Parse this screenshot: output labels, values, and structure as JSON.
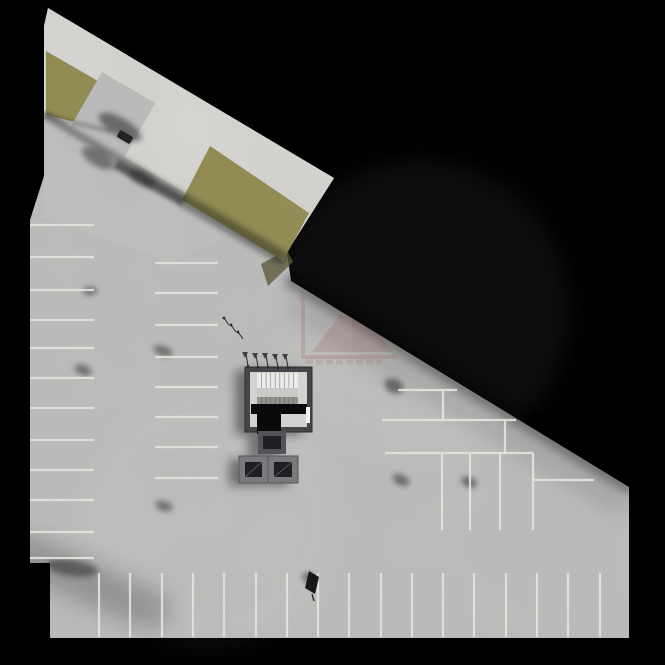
{
  "scene": {
    "w": 665,
    "h": 665,
    "colors": {
      "bg": "#000000",
      "floor": "#bdbdbc",
      "band": "#d9d8d4",
      "grass": "#8d8746",
      "grass_dark": "#595535",
      "line": "#edebe6",
      "wall": "#46464a",
      "wall_dark": "#2c2c2f",
      "core_floor": "#d3d2d0",
      "stair_light": "#ebebe9",
      "stair_mid": "#c9c9c7",
      "stair_dark": "#93938d",
      "pit": "#0a0a0c",
      "frame_light": "#7a7a7d",
      "frame_mid": "#525257",
      "inner_dark": "#1e1e23",
      "door": "#f2f2f0",
      "watermark": "#9c5c5c",
      "watermark_dark": "#7c4348",
      "mark": "#2b2b2b"
    },
    "site_outline": [
      [
        48,
        8
      ],
      [
        334,
        178
      ],
      [
        287,
        252
      ],
      [
        291,
        281
      ],
      [
        629,
        487
      ],
      [
        629,
        638
      ],
      [
        50,
        638
      ],
      [
        50,
        563
      ],
      [
        30,
        563
      ],
      [
        30,
        220
      ],
      [
        44,
        176
      ],
      [
        44,
        26
      ]
    ],
    "band_outline": [
      [
        48,
        8
      ],
      [
        334,
        178
      ],
      [
        287,
        252
      ],
      [
        44,
        110
      ],
      [
        44,
        26
      ]
    ],
    "plaza_overlay": [
      [
        44,
        116
      ],
      [
        240,
        232
      ],
      [
        170,
        262
      ],
      [
        44,
        218
      ]
    ],
    "grass_patches": [
      [
        [
          46,
          51
        ],
        [
          122,
          95
        ],
        [
          110,
          130
        ],
        [
          46,
          115
        ]
      ],
      [
        [
          210,
          146
        ],
        [
          309,
          213
        ],
        [
          283,
          261
        ],
        [
          182,
          200
        ]
      ]
    ],
    "grass_end_face": [
      [
        287,
        250
      ],
      [
        293,
        262
      ],
      [
        268,
        286
      ],
      [
        261,
        264
      ]
    ],
    "ramp": {
      "poly": [
        [
          102,
          72
        ],
        [
          155,
          103
        ],
        [
          113,
          178
        ],
        [
          60,
          145
        ]
      ],
      "slot": [
        [
          118,
          160
        ],
        [
          186,
          198
        ],
        [
          181,
          206
        ],
        [
          113,
          168
        ]
      ],
      "gate": {
        "x": 125,
        "y": 137,
        "w": 15,
        "h": 8,
        "angle": 31
      },
      "gate_arm": [
        131,
        141,
        141,
        148
      ]
    },
    "shadow_lines": [
      {
        "x1": 291,
        "y1": 281,
        "x2": 629,
        "y2": 487,
        "w": 12,
        "o": 0.45,
        "f": "b5"
      },
      {
        "x1": 300,
        "y1": 305,
        "x2": 620,
        "y2": 500,
        "w": 26,
        "o": 0.15,
        "f": "b12"
      },
      {
        "x1": 46,
        "y1": 116,
        "x2": 285,
        "y2": 255,
        "w": 7,
        "o": 0.4,
        "f": "b3"
      },
      {
        "x1": 184,
        "y1": 204,
        "x2": 281,
        "y2": 260,
        "w": 8,
        "o": 0.4,
        "f": "b3"
      },
      {
        "x1": 46,
        "y1": 116,
        "x2": 110,
        "y2": 131,
        "w": 4,
        "o": 0.3,
        "f": "b2"
      },
      {
        "x1": 31,
        "y1": 222,
        "x2": 31,
        "y2": 562,
        "w": 4,
        "o": 0.3,
        "f": "b2"
      },
      {
        "x1": 51,
        "y1": 564,
        "x2": 51,
        "y2": 636,
        "w": 4,
        "o": 0.3,
        "f": "b2"
      },
      {
        "x1": 31,
        "y1": 222,
        "x2": 94,
        "y2": 222,
        "w": 8,
        "o": 0.4,
        "f": "b3"
      },
      {
        "x1": 60,
        "y1": 634,
        "x2": 625,
        "y2": 634,
        "w": 8,
        "o": 0.25,
        "f": "b5"
      },
      {
        "x1": 25,
        "y1": 555,
        "x2": 150,
        "y2": 610,
        "w": 40,
        "o": 0.25,
        "f": "b12"
      }
    ],
    "shadow_blobs": [
      {
        "x": 90,
        "y": 291,
        "rx": 7,
        "ry": 4,
        "rot": 0,
        "o": 0.5
      },
      {
        "x": 83,
        "y": 370,
        "rx": 9,
        "ry": 5,
        "rot": 20,
        "o": 0.45
      },
      {
        "x": 163,
        "y": 351,
        "rx": 10,
        "ry": 5,
        "rot": 20,
        "o": 0.45
      },
      {
        "x": 164,
        "y": 506,
        "rx": 9,
        "ry": 5,
        "rot": 15,
        "o": 0.45
      },
      {
        "x": 394,
        "y": 386,
        "rx": 10,
        "ry": 7,
        "rot": 25,
        "o": 0.5
      },
      {
        "x": 401,
        "y": 480,
        "rx": 9,
        "ry": 5,
        "rot": 25,
        "o": 0.5
      },
      {
        "x": 469,
        "y": 482,
        "rx": 8,
        "ry": 5,
        "rot": 25,
        "o": 0.5
      },
      {
        "x": 309,
        "y": 578,
        "rx": 7,
        "ry": 5,
        "rot": 30,
        "o": 0.5
      },
      {
        "x": 120,
        "y": 127,
        "rx": 24,
        "ry": 9,
        "rot": 30,
        "o": 0.5
      },
      {
        "x": 98,
        "y": 158,
        "rx": 18,
        "ry": 8,
        "rot": 30,
        "o": 0.45
      },
      {
        "x": 142,
        "y": 178,
        "rx": 14,
        "ry": 7,
        "rot": 30,
        "o": 0.4
      },
      {
        "x": 72,
        "y": 568,
        "rx": 26,
        "ry": 8,
        "rot": 8,
        "o": 0.45
      }
    ],
    "light_blobs": [
      {
        "x": 420,
        "y": 310,
        "r": 150,
        "o": 0.05
      },
      {
        "x": 210,
        "y": 520,
        "r": 130,
        "o": 0.04
      }
    ],
    "parking_lines": {
      "left_col": {
        "x1": 30,
        "x2": 94,
        "ys": [
          225,
          257,
          290,
          320,
          348,
          378,
          408,
          440,
          470,
          500,
          532,
          558
        ]
      },
      "mid_col": {
        "x1": 155,
        "x2": 218,
        "ys": [
          263,
          293,
          325,
          357,
          387,
          417,
          447,
          478
        ]
      },
      "bottom_row": {
        "y1": 573,
        "y2": 637,
        "xs": [
          99,
          130,
          162,
          193,
          224,
          256,
          287,
          318,
          349,
          381,
          412,
          443,
          474,
          506,
          537,
          568,
          600
        ]
      },
      "right_segments": [
        {
          "x1": 398,
          "y1": 390,
          "x2": 457,
          "y2": 390
        },
        {
          "x1": 443,
          "y1": 390,
          "x2": 443,
          "y2": 420
        },
        {
          "x1": 382,
          "y1": 420,
          "x2": 516,
          "y2": 420
        },
        {
          "x1": 505,
          "y1": 420,
          "x2": 505,
          "y2": 453
        },
        {
          "x1": 385,
          "y1": 453,
          "x2": 533,
          "y2": 453
        },
        {
          "x1": 442,
          "y1": 453,
          "x2": 442,
          "y2": 530
        },
        {
          "x1": 470,
          "y1": 453,
          "x2": 470,
          "y2": 530
        },
        {
          "x1": 500,
          "y1": 453,
          "x2": 500,
          "y2": 530
        },
        {
          "x1": 533,
          "y1": 453,
          "x2": 533,
          "y2": 530
        },
        {
          "x1": 533,
          "y1": 480,
          "x2": 594,
          "y2": 480
        }
      ]
    },
    "core": {
      "room": {
        "x": 245,
        "y": 367,
        "w": 67,
        "h": 65
      },
      "inner": {
        "x": 250,
        "y": 372,
        "w": 57,
        "h": 55
      },
      "treads": {
        "x": 257,
        "y": 373,
        "w": 41,
        "h": 15,
        "n": 9
      },
      "landing": {
        "x": 257,
        "y": 388,
        "w": 41,
        "h": 9
      },
      "flight2": {
        "x": 257,
        "y": 397,
        "w": 41,
        "h": 7,
        "n": 9
      },
      "pit_bar": {
        "x": 251,
        "y": 404,
        "w": 56,
        "h": 10
      },
      "pit_block": {
        "x": 257,
        "y": 413,
        "w": 24,
        "h": 21
      },
      "door": {
        "x": 306,
        "y": 407,
        "w": 4,
        "h": 16
      },
      "vent": {
        "x": 258,
        "y": 431,
        "w": 28,
        "h": 23,
        "inset": 5
      },
      "boxes": [
        {
          "x": 239,
          "y": 456,
          "w": 29,
          "h": 27,
          "inset": 6
        },
        {
          "x": 268,
          "y": 456,
          "w": 30,
          "h": 27,
          "inset": 6
        }
      ]
    },
    "marks": {
      "sprinklers": [
        [
          248,
          366
        ],
        [
          258,
          367
        ],
        [
          268,
          367
        ],
        [
          278,
          368
        ],
        [
          288,
          368
        ]
      ],
      "bikes": [
        [
          224,
          318
        ],
        [
          231,
          325
        ],
        [
          238,
          332
        ]
      ],
      "sign": {
        "poly": [
          [
            309,
            571
          ],
          [
            319,
            577
          ],
          [
            315,
            594
          ],
          [
            305,
            588
          ]
        ],
        "stem": [
          312,
          594,
          314,
          601
        ]
      }
    },
    "watermark": {
      "bracket": [
        [
          303,
          291
        ],
        [
          303,
          357
        ],
        [
          397,
          357
        ]
      ],
      "pyramid": [
        [
          312,
          352
        ],
        [
          352,
          299
        ],
        [
          393,
          352
        ]
      ],
      "pyramid_shade": [
        [
          352,
          299
        ],
        [
          393,
          352
        ],
        [
          352,
          352
        ]
      ],
      "text_line": {
        "x1": 306,
        "y1": 362,
        "x2": 382,
        "y2": 362
      },
      "opacity": 0.26
    },
    "cars": [
      {
        "x": 63,
        "y": 241,
        "angle": -90,
        "color": "#4a589c",
        "glass": "#14161c"
      },
      {
        "x": 63,
        "y": 274,
        "angle": -87,
        "color": "#e9e9e7",
        "glass": "#1c1f26"
      },
      {
        "x": 62,
        "y": 456,
        "angle": -90,
        "color": "#4353a2",
        "glass": "#14161c"
      },
      {
        "x": 188,
        "y": 277,
        "angle": -90,
        "color": "#3d55b8",
        "glass": "#14161c"
      },
      {
        "x": 187,
        "y": 432,
        "angle": -91,
        "color": "#ececea",
        "glass": "#1c1f26"
      },
      {
        "x": 517,
        "y": 479,
        "angle": 0,
        "color": "#eeeeec",
        "glass": "#1c1f26"
      },
      {
        "x": 114,
        "y": 605,
        "angle": 0,
        "color": "#ececea",
        "glass": "#1c1f26"
      },
      {
        "x": 209,
        "y": 604,
        "angle": 0,
        "color": "#191a1d",
        "glass": "#0c0d10"
      },
      {
        "x": 271,
        "y": 605,
        "angle": 0,
        "color": "#2f50c5",
        "glass": "#12141a"
      },
      {
        "x": 427,
        "y": 604,
        "angle": 0,
        "color": "#2f50c5",
        "glass": "#12141a"
      },
      {
        "x": 458,
        "y": 604,
        "angle": 0,
        "color": "#3d3f45",
        "glass": "#101114"
      },
      {
        "x": 583,
        "y": 603,
        "angle": 2,
        "color": "#ededeb",
        "glass": "#1c1f26"
      }
    ]
  }
}
